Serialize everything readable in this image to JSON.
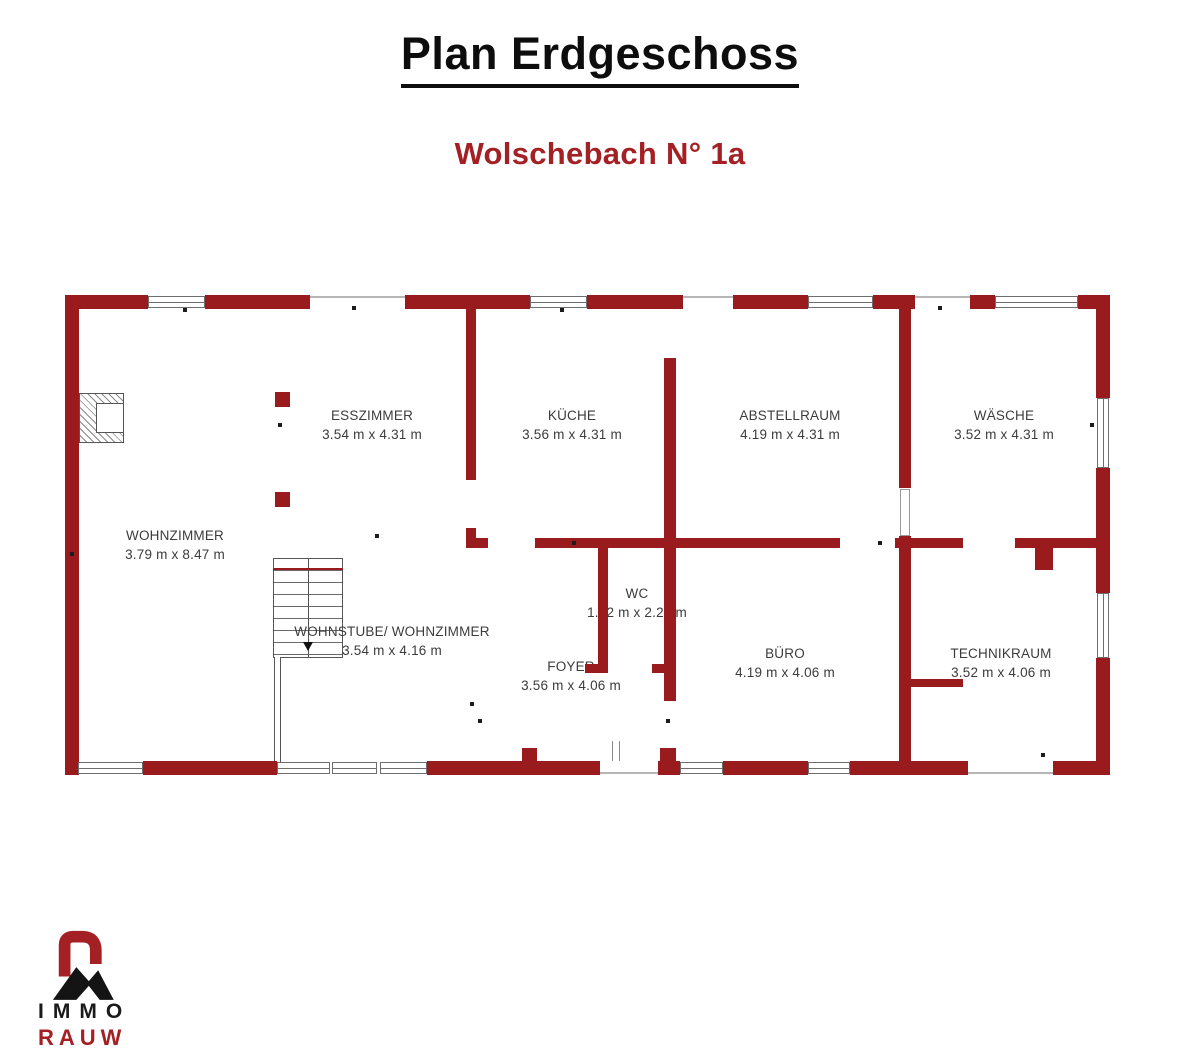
{
  "title": "Plan Erdgeschoss",
  "subtitle": "Wolschebach N° 1a",
  "colors": {
    "wall": "#9a1b1e",
    "accent_text": "#a32025",
    "label_text": "#3c3c3c"
  },
  "rooms": [
    {
      "name": "WOHNZIMMER",
      "dims": "3.79 m x 8.47 m"
    },
    {
      "name": "ESSZIMMER",
      "dims": "3.54 m x 4.31 m"
    },
    {
      "name": "KÜCHE",
      "dims": "3.56 m x 4.31 m"
    },
    {
      "name": "ABSTELLRAUM",
      "dims": "4.19 m x 4.31 m"
    },
    {
      "name": "WÄSCHE",
      "dims": "3.52 m x 4.31 m"
    },
    {
      "name": "WOHNSTUBE/ WOHNZIMMER",
      "dims": "3.54 m x 4.16 m"
    },
    {
      "name": "WC",
      "dims": "1.12 m x 2.22 m"
    },
    {
      "name": "FOYER",
      "dims": "3.56 m x 4.06 m"
    },
    {
      "name": "BÜRO",
      "dims": "4.19 m x 4.06 m"
    },
    {
      "name": "TECHNIKRAUM",
      "dims": "3.52 m x 4.06 m"
    }
  ],
  "logo": {
    "line1": "IMMO",
    "line2": "RAUW"
  }
}
